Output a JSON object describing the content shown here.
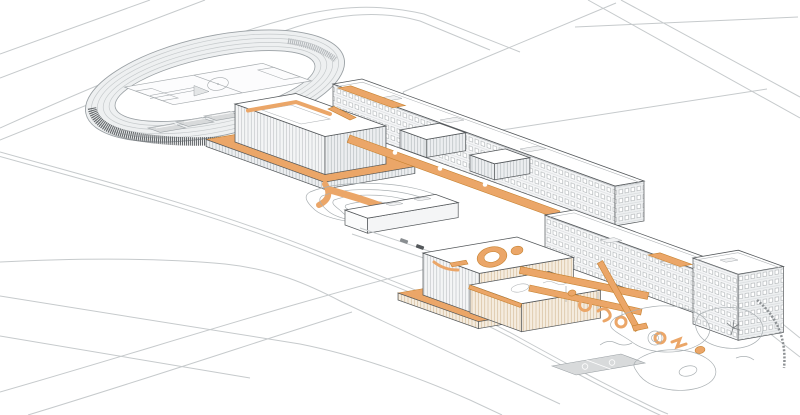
{
  "scene": {
    "kind": "axonometric-architectural-illustration",
    "subject": "school-campus-masterplan-with-orange-circulation-highlights"
  },
  "palette": {
    "background": "#ffffff",
    "accent": "#eba668",
    "accent_dark": "#c5812f",
    "accent_light": "#f3c491",
    "line_light": "#c6cacc",
    "line_mid": "#9aa0a4",
    "line_dark": "#54585b",
    "court_fill": "#d8dadb",
    "bleacher_dark": "#63676a"
  },
  "features": [
    {
      "name": "running-track",
      "highlight": false
    },
    {
      "name": "soccer-field",
      "highlight": false
    },
    {
      "name": "grandstand",
      "highlight": false
    },
    {
      "name": "sports-courts",
      "highlight": false
    },
    {
      "name": "gymnasium-block",
      "highlight": false
    },
    {
      "name": "north-classroom-slab",
      "highlight": false
    },
    {
      "name": "north-orange-terrace",
      "highlight": true
    },
    {
      "name": "elevated-walkway",
      "highlight": true
    },
    {
      "name": "roof-paths",
      "highlight": true
    },
    {
      "name": "amphitheater-mound",
      "highlight": false
    },
    {
      "name": "pavilion",
      "highlight": false
    },
    {
      "name": "vehicles",
      "highlight": false
    },
    {
      "name": "auditorium-roof-ring",
      "highlight": true
    },
    {
      "name": "south-orange-terrace",
      "highlight": true
    },
    {
      "name": "roof-garden-block",
      "highlight": false
    },
    {
      "name": "south-classroom-slab",
      "highlight": false
    },
    {
      "name": "corner-tower",
      "highlight": false
    },
    {
      "name": "sky-bridges",
      "highlight": true
    },
    {
      "name": "courtyard-ground-graphics",
      "highlight": true
    },
    {
      "name": "landscape-garden",
      "highlight": false
    },
    {
      "name": "basketball-court",
      "highlight": false
    },
    {
      "name": "site-roads",
      "highlight": false
    }
  ]
}
